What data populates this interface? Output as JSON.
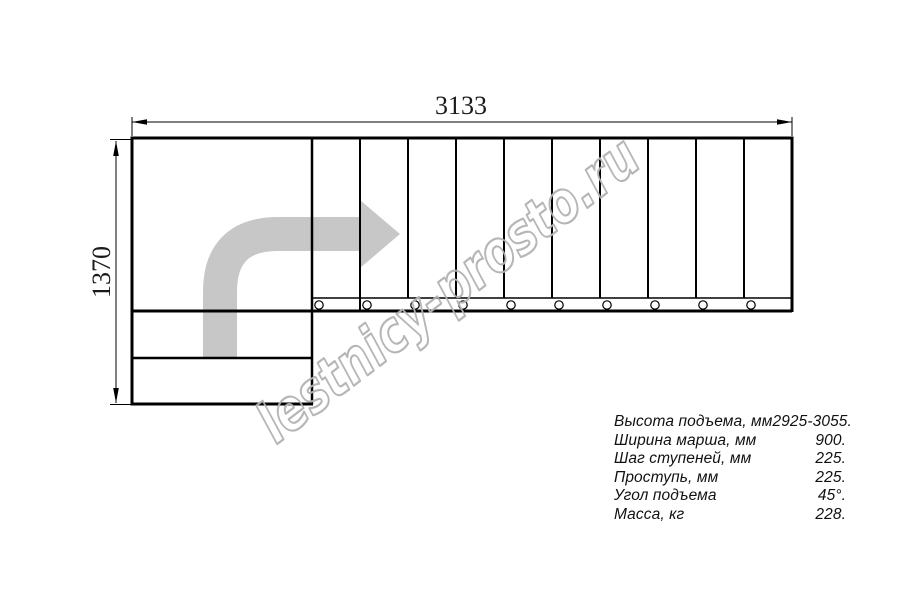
{
  "drawing": {
    "type": "l-shaped-staircase-plan",
    "tread_count": 10,
    "landing_lower_steps": 2,
    "direction": "up-then-right"
  },
  "dimensions": {
    "width": "3133",
    "height": "1370"
  },
  "watermark": {
    "text": "lestnicy-prosto.ru"
  },
  "specs": {
    "rows": [
      {
        "label": "Высота подъема, мм",
        "value": "2925-3055."
      },
      {
        "label": "Ширина марша, мм",
        "value": "900."
      },
      {
        "label": "Шаг ступеней, мм",
        "value": "225."
      },
      {
        "label": "Проступь, мм",
        "value": "225."
      },
      {
        "label": "Угол подъема",
        "value": "45°."
      },
      {
        "label": "Масса, кг",
        "value": "228."
      }
    ]
  },
  "colors": {
    "line": "#000000",
    "arrow": "#c7c7c7",
    "watermark": "#b3b3b3"
  }
}
